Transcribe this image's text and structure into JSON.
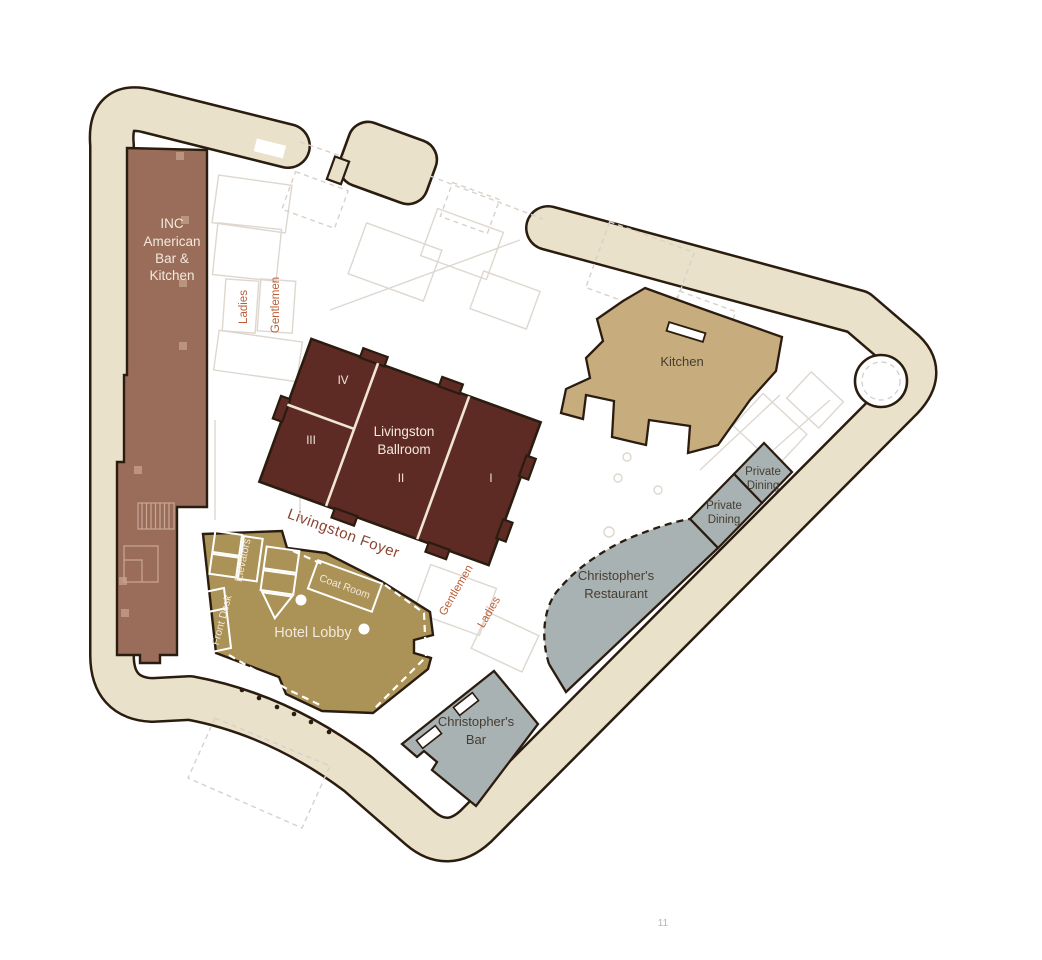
{
  "page": {
    "number": "11"
  },
  "colors": {
    "wall_band": "#e9e1c9",
    "outline": "#2b1c10",
    "inc": "#9a6c5a",
    "inc_column": "#bb9480",
    "ballroom": "#5e2a24",
    "ballroom_divider": "#f0e6d4",
    "kitchen": "#c7ac7e",
    "lobby": "#ab9256",
    "gray_area": "#a9b2b3",
    "orange_label": "#bb5e36",
    "foyer_label": "#8a4433",
    "light_text": "#f2e9dc",
    "dark_text": "#463c30"
  },
  "areas": {
    "inc": {
      "label_lines": [
        "INC",
        "American",
        "Bar &",
        "Kitchen"
      ]
    },
    "ballroom": {
      "name_lines": [
        "Livingston",
        "Ballroom"
      ],
      "sections": [
        "I",
        "II",
        "III",
        "IV"
      ]
    },
    "kitchen": {
      "label": "Kitchen"
    },
    "private_dining": {
      "label_lines": [
        "Private",
        "Dining"
      ]
    },
    "restaurant": {
      "label_lines": [
        "Christopher's",
        "Restaurant"
      ]
    },
    "bar": {
      "label_lines": [
        "Christopher's",
        "Bar"
      ]
    },
    "lobby": {
      "label": "Hotel Lobby"
    },
    "foyer": {
      "label": "Livingston Foyer"
    },
    "coat_room": {
      "label": "Coat Room"
    },
    "front_desk": {
      "label": "Front Desk"
    },
    "elevators": {
      "label": "Elevators"
    },
    "restrooms_upper": {
      "ladies": "Ladies",
      "gentlemen": "Gentlemen"
    },
    "restrooms_lower": {
      "ladies": "Ladies",
      "gentlemen": "Gentlemen"
    }
  }
}
